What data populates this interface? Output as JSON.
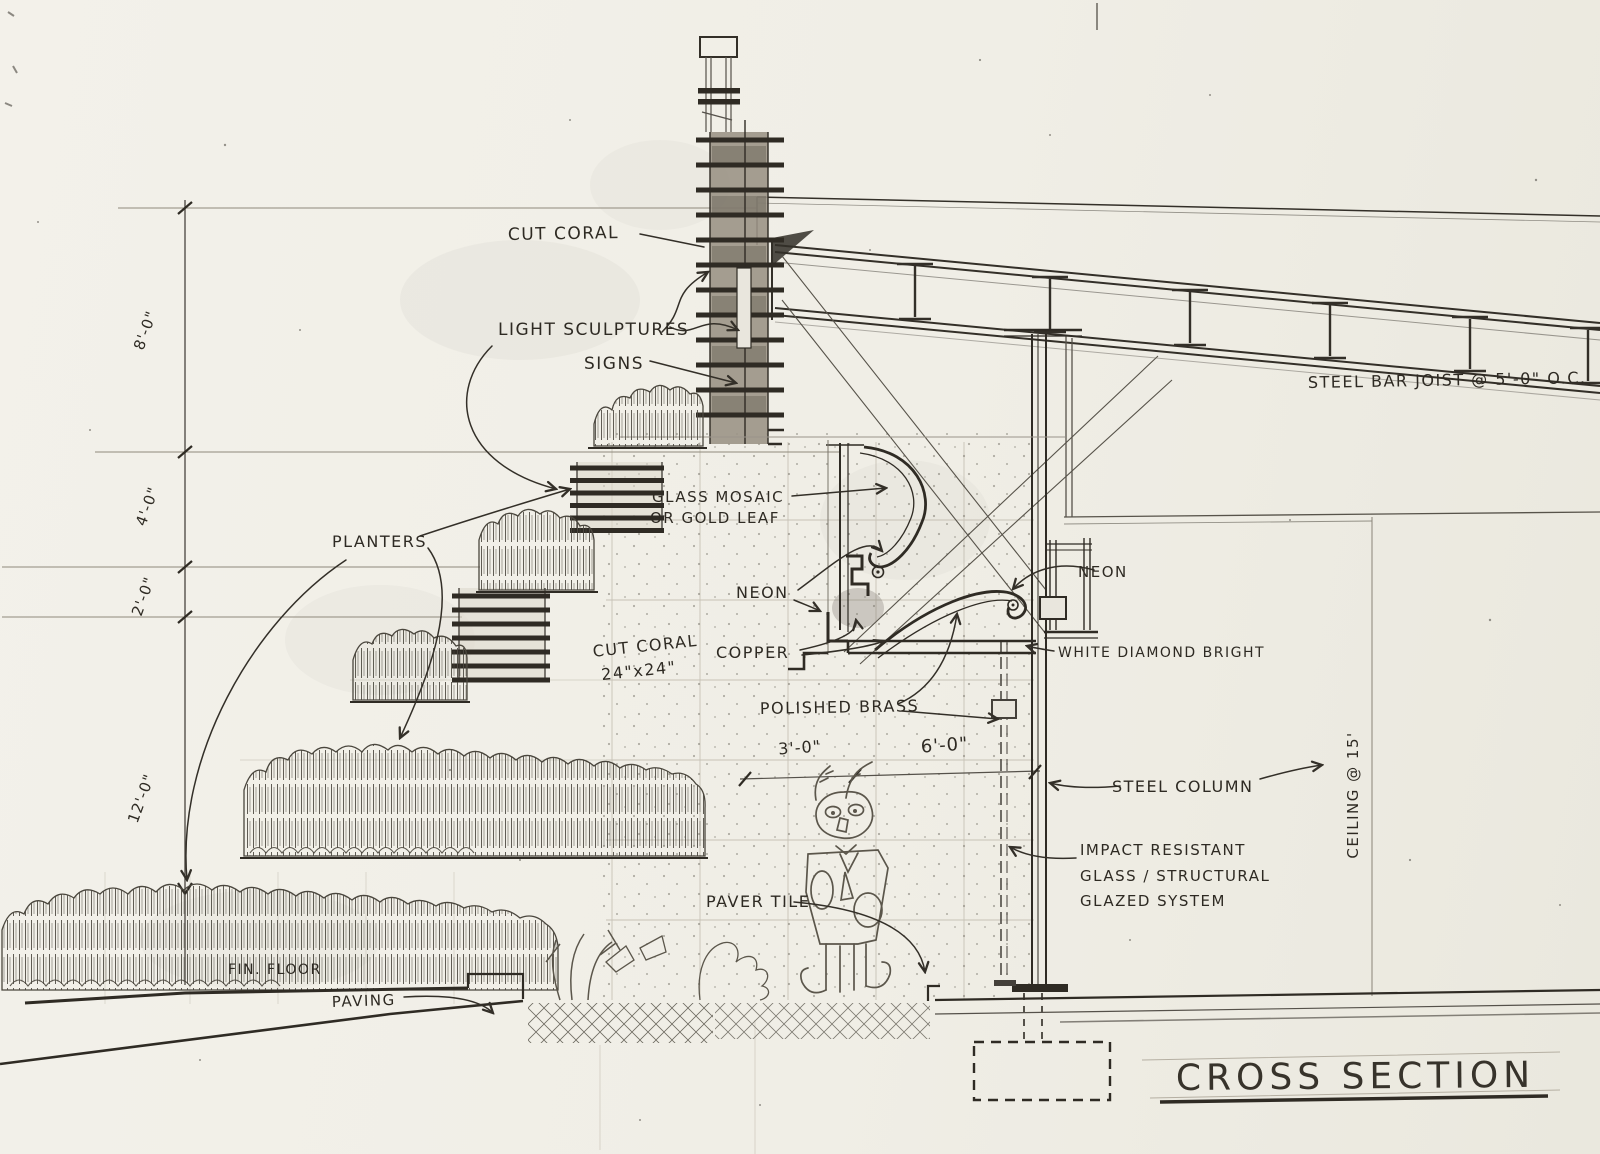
{
  "drawing": {
    "title": "CROSS SECTION",
    "labels": {
      "cut_coral": "CUT CORAL",
      "light_sculptures": "LIGHT SCULPTURES",
      "signs": "SIGNS",
      "steel_bar_joist": "STEEL BAR JOIST @ 5'-0\" O.C.",
      "glass_mosaic_1": "GLASS MOSAIC",
      "glass_mosaic_2": "OR GOLD LEAF",
      "planters": "PLANTERS",
      "neon_left": "NEON",
      "neon_right": "NEON",
      "cut_coral_tile_1": "CUT CORAL",
      "cut_coral_tile_2": "24\"x24\"",
      "copper": "COPPER",
      "white_diamond_bright": "WHITE DIAMOND BRIGHT",
      "polished_brass": "POLISHED BRASS",
      "steel_column": "STEEL COLUMN",
      "impact_1": "IMPACT RESISTANT",
      "impact_2": "GLASS / STRUCTURAL",
      "impact_3": "GLAZED SYSTEM",
      "ceiling": "CEILING @ 15'",
      "paver_tile": "PAVER TILE",
      "fin_floor": "FIN. FLOOR",
      "paving": "PAVING"
    },
    "dimensions": {
      "v8": "8'-0\"",
      "v4": "4'-0\"",
      "v2": "2'-0\"",
      "v12": "12'-0\"",
      "h3": "3'-0\"",
      "h6": "6'-0\""
    },
    "colors": {
      "paper": "#f1efe7",
      "ink": "#2f2b24",
      "pencil": "#6e6a5f"
    }
  }
}
